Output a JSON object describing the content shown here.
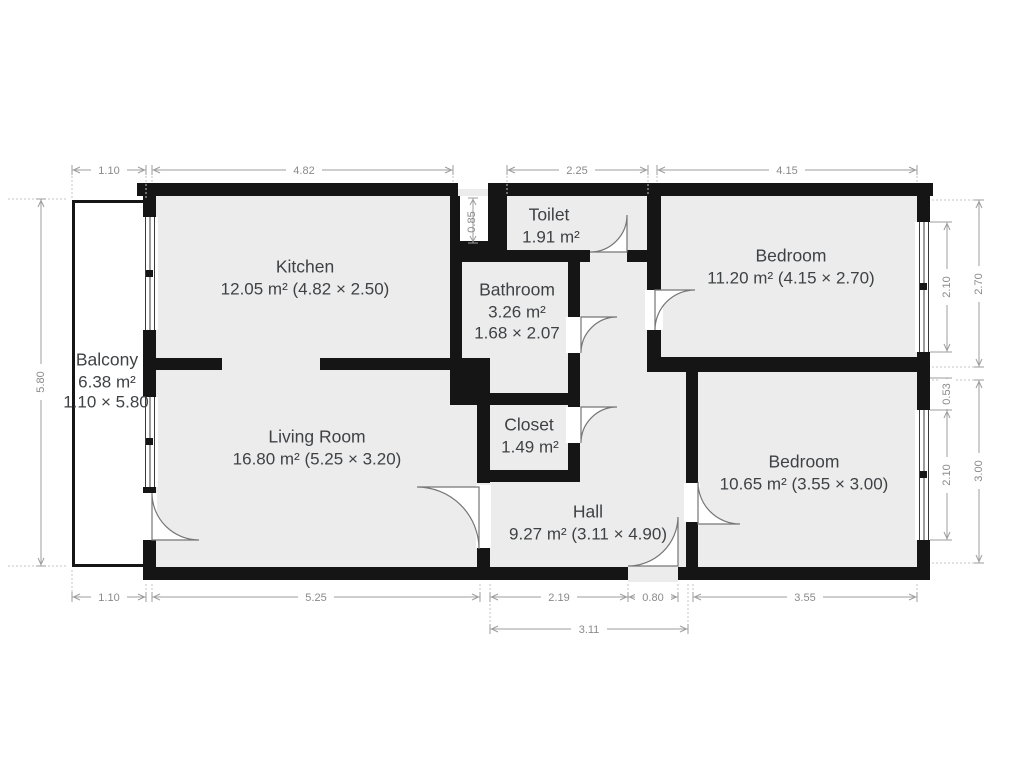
{
  "plan": {
    "rooms": {
      "kitchen": {
        "name": "Kitchen",
        "area": "12.05 m² (4.82 × 2.50)"
      },
      "living_room": {
        "name": "Living Room",
        "area": "16.80 m² (5.25 × 3.20)"
      },
      "balcony": {
        "name": "Balcony",
        "area": "6.38 m²",
        "size": "1.10 × 5.80"
      },
      "toilet": {
        "name": "Toilet",
        "area": "1.91 m²"
      },
      "bathroom": {
        "name": "Bathroom",
        "area": "3.26 m²",
        "size": "1.68 × 2.07"
      },
      "closet": {
        "name": "Closet",
        "area": "1.49 m²"
      },
      "hall": {
        "name": "Hall",
        "area": "9.27 m² (3.11 × 4.90)"
      },
      "bedroom_top": {
        "name": "Bedroom",
        "area": "11.20 m² (4.15 × 2.70)"
      },
      "bedroom_bottom": {
        "name": "Bedroom",
        "area": "10.65 m² (3.55 × 3.00)"
      }
    },
    "dims": {
      "top": [
        "1.10",
        "4.82",
        "2.25",
        "4.15"
      ],
      "bottom": [
        "1.10",
        "5.25",
        "2.19",
        "0.80",
        "3.55"
      ],
      "bottom2": "3.11",
      "left": "5.80",
      "shaft": "0.85",
      "right_windows": [
        "2.10",
        "0.53",
        "2.10"
      ],
      "right_rooms": [
        "2.70",
        "3.00"
      ]
    },
    "colors": {
      "wall": "#151515",
      "floor": "#ececec",
      "dim_line": "#9e9e9e",
      "dim_text": "#8a8a8a",
      "room_text": "#3f4245"
    }
  }
}
